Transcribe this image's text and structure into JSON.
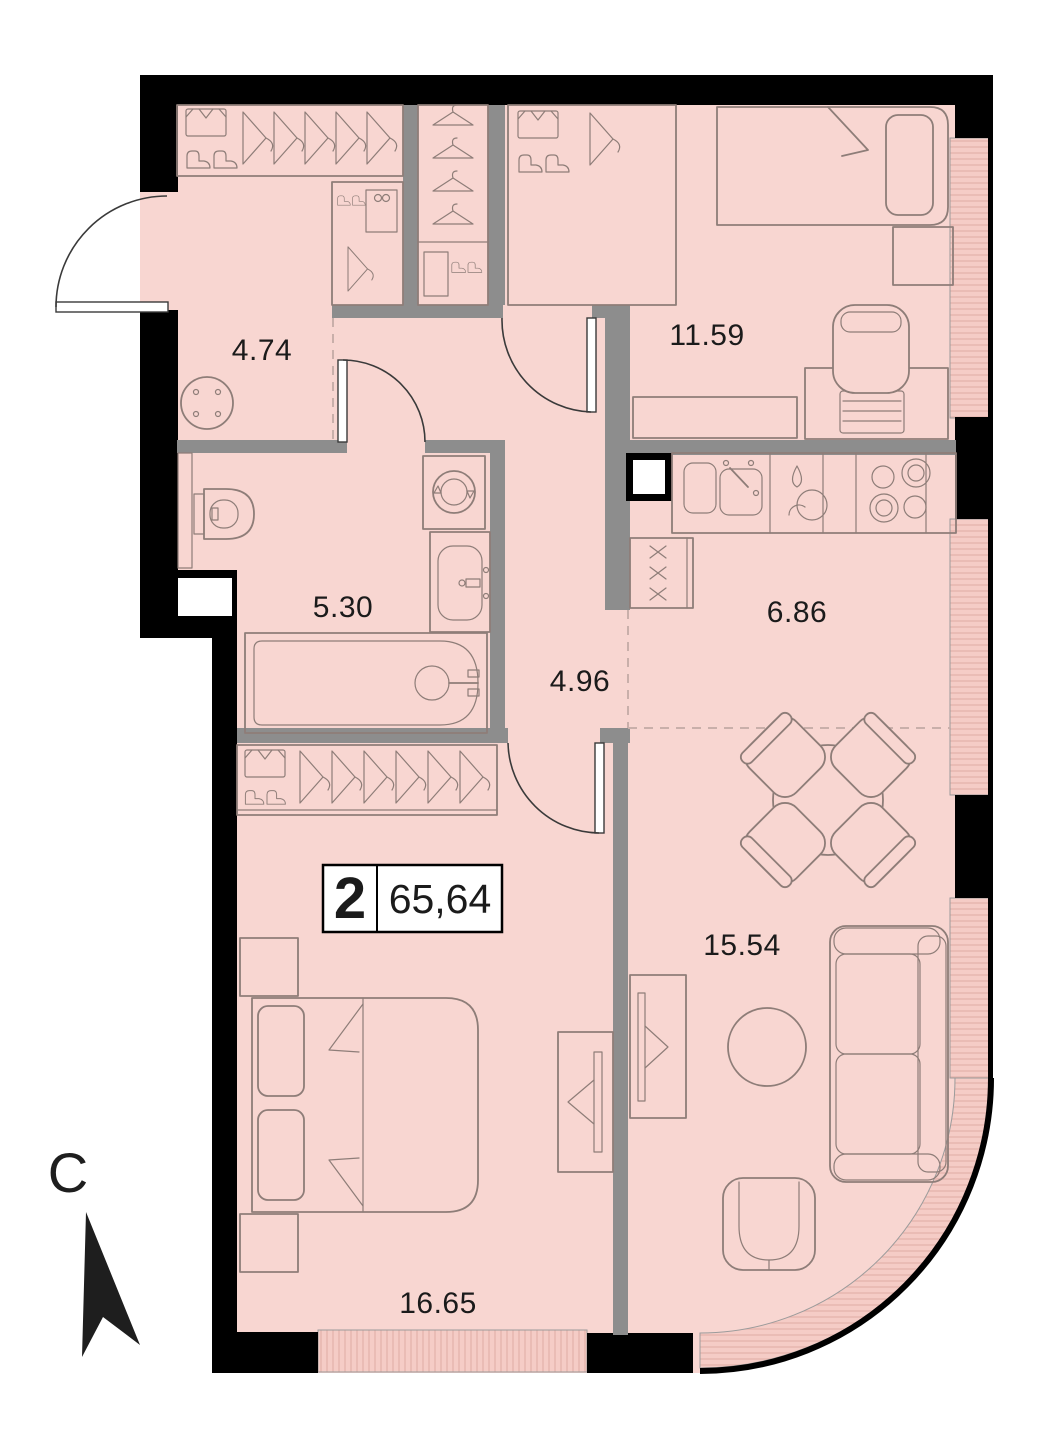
{
  "floorplan": {
    "title": "2-room apartment floor plan",
    "badge": {
      "rooms_count": "2",
      "total_area": "65,64"
    },
    "compass": {
      "north_label": "С"
    },
    "rooms": [
      {
        "name": "entry-hall",
        "area": "4.74"
      },
      {
        "name": "bedroom",
        "area": "11.59"
      },
      {
        "name": "bathroom",
        "area": "5.30"
      },
      {
        "name": "hallway",
        "area": "4.96"
      },
      {
        "name": "kitchen",
        "area": "6.86"
      },
      {
        "name": "living-room",
        "area": "15.54"
      },
      {
        "name": "master-bedroom",
        "area": "16.65"
      }
    ],
    "colors": {
      "room_fill": "#f8d6d1",
      "window_fill": "#f5ccc6",
      "window_line": "#e3b1aa",
      "wall_black": "#000000",
      "wall_gray": "#8d8d8d",
      "furniture": "#8e7d78",
      "door": "#3a3a3a",
      "dash": "#c9afaa",
      "label": "#1b1b1b",
      "badge_bg": "#ffffff",
      "badge_border": "#000000",
      "compass": "#1e1e1e"
    }
  }
}
